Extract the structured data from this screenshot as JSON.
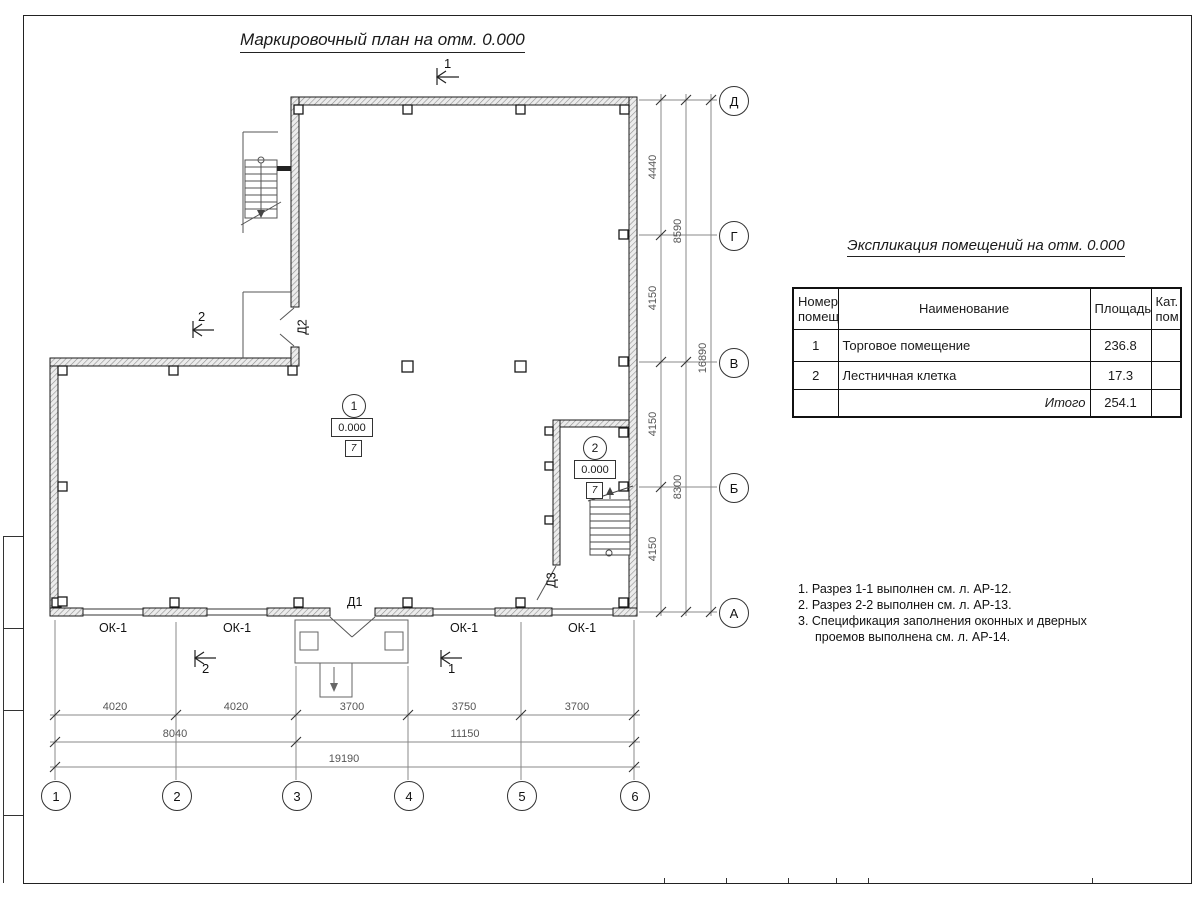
{
  "sheet": {
    "plan_title": "Маркировочный план на отм. 0.000"
  },
  "plan": {
    "axis_rows": [
      "Д",
      "Г",
      "В",
      "Б",
      "А"
    ],
    "axis_cols": [
      "1",
      "2",
      "3",
      "4",
      "5",
      "6"
    ],
    "window_labels": [
      "ОК-1",
      "ОК-1",
      "ОК-1",
      "ОК-1"
    ],
    "door_labels": {
      "d1": "Д1",
      "d2": "Д2",
      "d3": "Д3"
    },
    "section_marks": {
      "s1": "1",
      "s2": "2"
    },
    "rooms": [
      {
        "number": "1",
        "elevation": "0.000",
        "category": "7"
      },
      {
        "number": "2",
        "elevation": "0.000",
        "category": "7"
      }
    ],
    "dims_right": {
      "inner": [
        "4440",
        "4150",
        "4150",
        "4150"
      ],
      "mid": [
        "8590",
        "8300"
      ],
      "total": "16890"
    },
    "dims_bottom": {
      "inner": [
        "4020",
        "4020",
        "3700",
        "3750",
        "3700"
      ],
      "mid": [
        "8040",
        "11150"
      ],
      "total": "19190"
    }
  },
  "schedule": {
    "title": "Экспликация помещений на отм. 0.000",
    "headers": {
      "number": "Номер помещ.",
      "name": "Наименование",
      "area": "Площадь",
      "category": "Кат. пом."
    },
    "rows": [
      {
        "number": "1",
        "name": "Торговое помещение",
        "area": "236.8",
        "category": ""
      },
      {
        "number": "2",
        "name": "Лестничная клетка",
        "area": "17.3",
        "category": ""
      }
    ],
    "total_label": "Итого",
    "total_area": "254.1"
  },
  "notes": {
    "items": [
      "1. Разрез 1-1 выполнен см. л. АР-12.",
      "2. Разрез 2-2 выполнен см. л. АР-13.",
      "3. Спецификация заполнения оконных и дверных проемов выполнена см. л. АР-14."
    ]
  }
}
